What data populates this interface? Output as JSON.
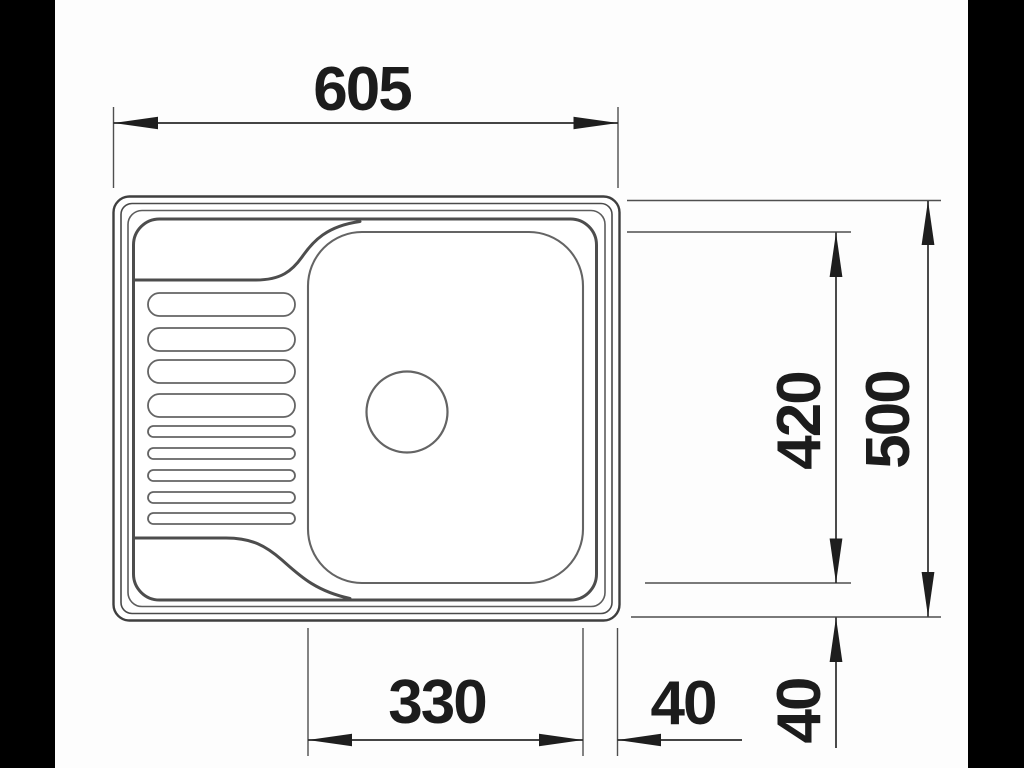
{
  "meta": {
    "type": "technical-drawing",
    "subject": "Kitchen sink with drainboard, top view, dimensioned"
  },
  "dimensions": {
    "overall_width": "605",
    "overall_depth": "500",
    "bowl_length": "420",
    "bowl_width": "330",
    "bowl_to_edge_right": "40",
    "bowl_to_edge_bottom": "40"
  },
  "colors": {
    "background": "#fdfdfd",
    "letterbox": "#000000",
    "drawing_line": "#4d4d4d",
    "dimension_line": "#2a2a2a",
    "text": "#1c1c1c"
  }
}
